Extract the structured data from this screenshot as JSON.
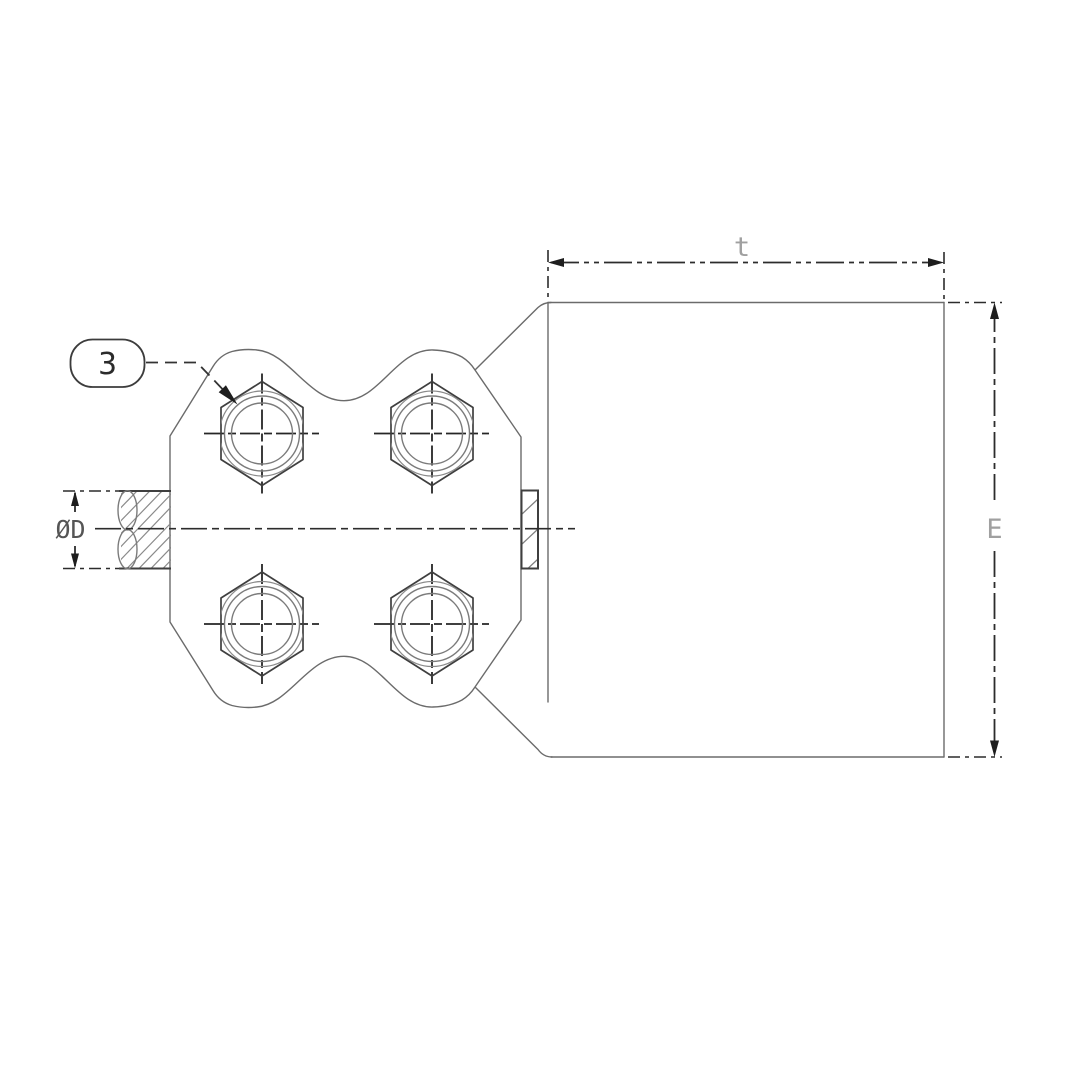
{
  "drawing": {
    "balloon_label": "3",
    "dim_width_label": "t",
    "dim_height_label": "E",
    "dim_diameter_label": "ØD",
    "colors": {
      "outline": "#6b6b6b",
      "strong_line": "#2c2c2c",
      "dim_label_gray": "#a0a0a0",
      "background": "#ffffff"
    }
  }
}
